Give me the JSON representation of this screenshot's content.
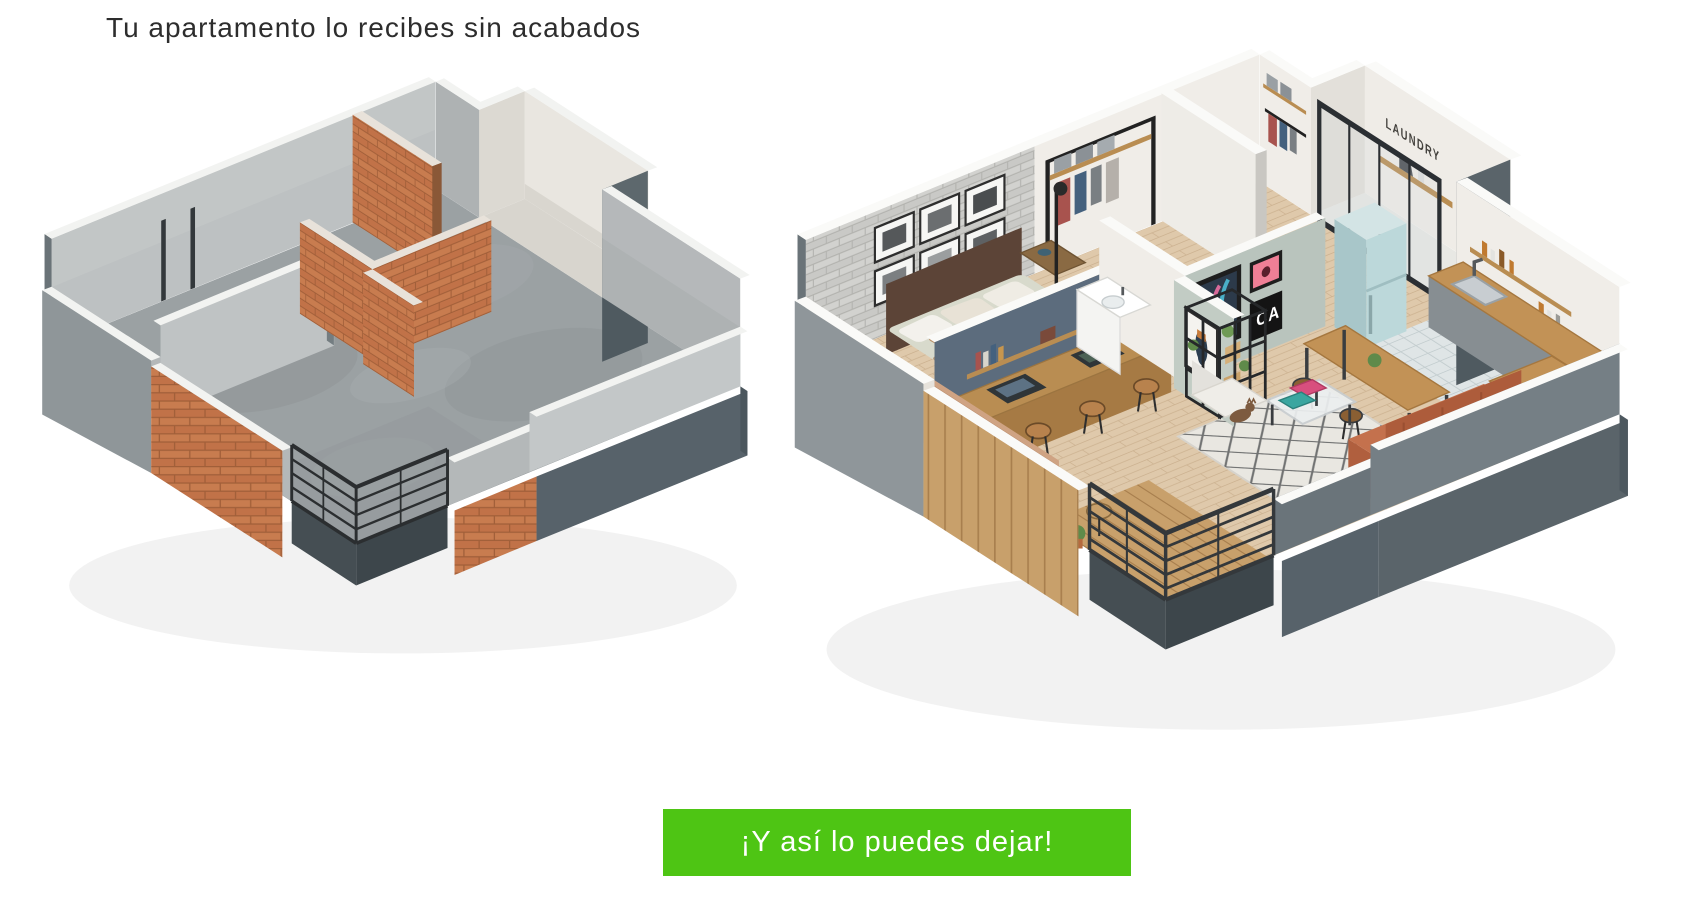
{
  "header": {
    "title": "Tu apartamento lo recibes sin acabados",
    "color": "#2d2d2d"
  },
  "banner": {
    "label": "¡Y así lo puedes dejar!",
    "background": "#4ec514",
    "text_color": "#ffffff"
  },
  "plans": {
    "unfinished": {
      "materials": {
        "concrete_wall": "#bdc1c2",
        "concrete_floor": "#9ba1a3",
        "brick": "#c87c4f",
        "wall_cap": "#f2f3f1",
        "exterior_skirt": "#57626a",
        "railing": "#2b2e30"
      }
    },
    "furnished": {
      "labels": {
        "laundry_sign": "LAUNDRY",
        "poster_ca": "CA"
      },
      "materials": {
        "wall_white": "#f0ede8",
        "wood_floor": "#dfc9ab",
        "blue_wall": "#5c6c7d",
        "gray_brick": "#d2d2cf",
        "sage_wall": "#b9c4bd",
        "fridge": "#bcd8da",
        "sofa": "#c4714d",
        "counter_wood": "#c29256",
        "rug": "#e9e7e1",
        "railing": "#34383b",
        "exterior_skirt": "#5a646a"
      }
    }
  }
}
